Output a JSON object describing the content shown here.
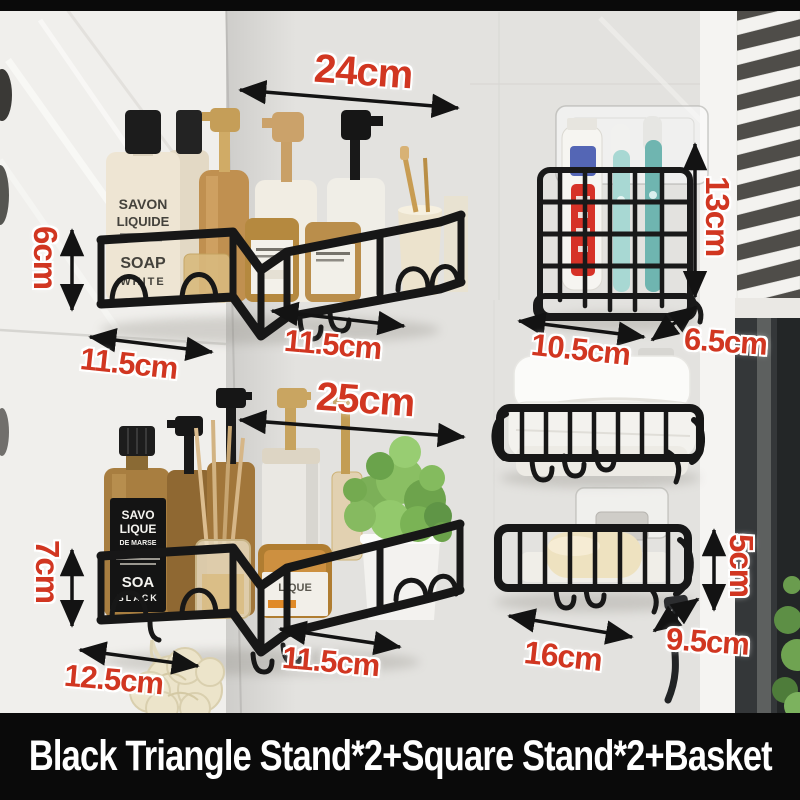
{
  "banner": {
    "text": "Black Triangle Stand*2+Square Stand*2+Basket"
  },
  "colors": {
    "accent_red": "#d13621",
    "shelf_black": "#171717",
    "banner_bg": "#0a0a0a"
  },
  "dimensions": {
    "shelf1": {
      "width": "24cm",
      "height": "6cm",
      "left_depth": "11.5cm",
      "right_depth": "11.5cm"
    },
    "toothbrush_holder": {
      "height": "13cm",
      "width": "10.5cm",
      "depth": "6.5cm"
    },
    "shelf2": {
      "width": "25cm",
      "height": "7cm",
      "left_depth": "12.5cm",
      "right_depth": "11.5cm"
    },
    "soap_dish": {
      "height": "5cm",
      "width": "16cm",
      "depth": "9.5cm"
    }
  },
  "product_labels": {
    "bottle1_l1": "SAVON",
    "bottle1_l2": "LIQUIDE",
    "bottle1_l3": "SOAP",
    "bottle1_l4": "WHITE",
    "bottle2_l1": "SAVO",
    "bottle2_l2": "LIQUE",
    "bottle2_l3": "DE MARSE",
    "bottle2_l4": "SOA",
    "bottle2_l5": "BLACK",
    "jar_label": "LIQUE"
  }
}
